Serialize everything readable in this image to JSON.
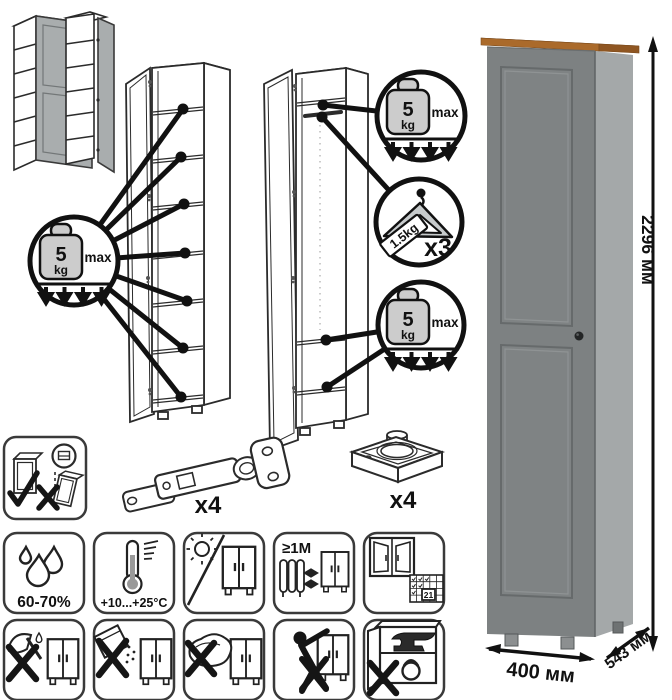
{
  "callouts": {
    "weight": {
      "value": "5",
      "unit": "kg",
      "max_label": "max"
    },
    "hanger": {
      "weight_label": "1.5kg",
      "count_label": "x3"
    }
  },
  "hardware": {
    "hinge_count_label": "x4",
    "foot_count_label": "x4"
  },
  "care": {
    "humidity_label": "60-70%",
    "temperature_label": "+10...+25°C",
    "distance_label": "≥1М",
    "calendar_day": "21"
  },
  "dimensions": {
    "height_label": "2296 мм",
    "width_label": "400 мм",
    "depth_label": "543 мм"
  },
  "colors": {
    "cabinet_front": "#7d8182",
    "cabinet_side": "#a4a8a9",
    "wood_top": "#aa6a2b",
    "wood_top_light": "#c9954a",
    "door_gray": "#a9adae"
  }
}
